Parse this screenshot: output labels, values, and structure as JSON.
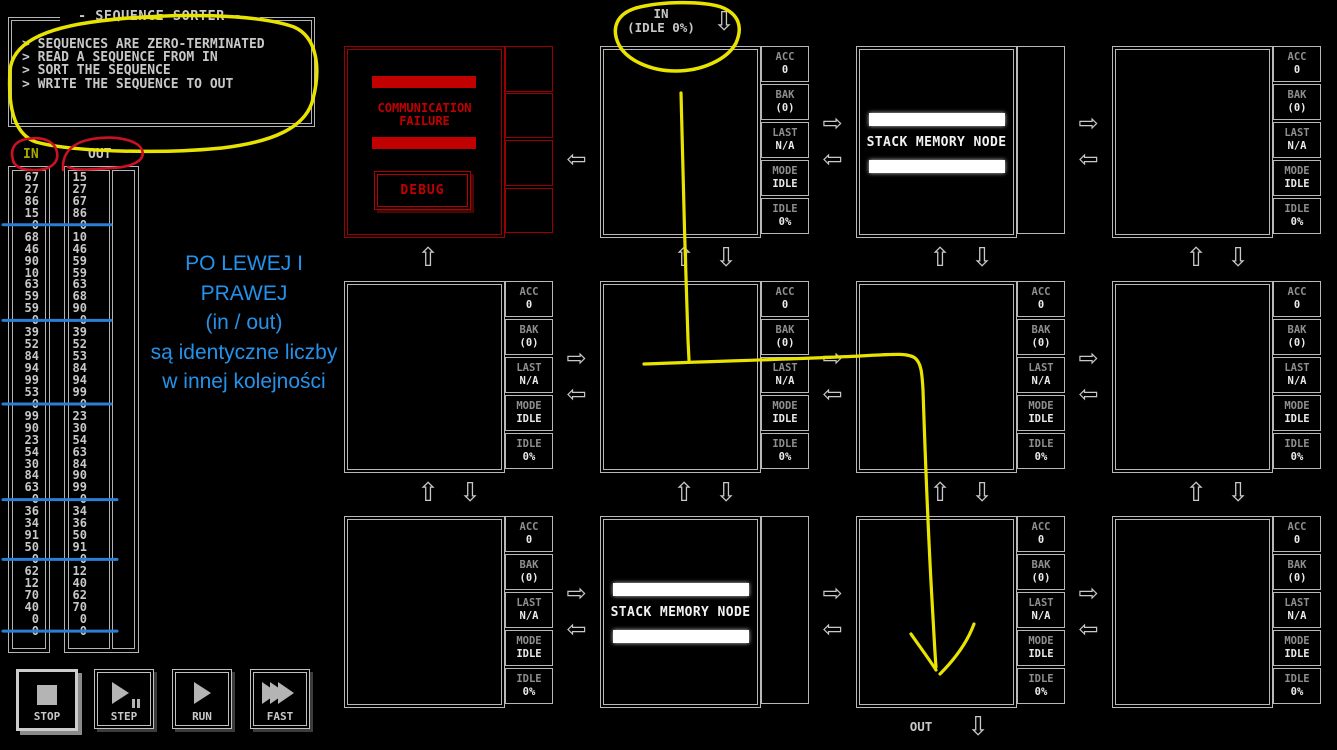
{
  "page": {
    "title": "- SEQUENCE SORTER -"
  },
  "description": [
    "> SEQUENCES ARE ZERO-TERMINATED",
    "> READ A SEQUENCE FROM IN",
    "> SORT THE SEQUENCE",
    "> WRITE THE SEQUENCE TO OUT"
  ],
  "io": {
    "in_label": "IN",
    "out_label": "OUT",
    "in_values": [
      67,
      27,
      86,
      15,
      0,
      68,
      46,
      90,
      10,
      63,
      59,
      59,
      0,
      39,
      52,
      84,
      94,
      99,
      53,
      0,
      99,
      90,
      23,
      54,
      30,
      84,
      63,
      0,
      36,
      34,
      91,
      50,
      0,
      62,
      12,
      70,
      40,
      0,
      0
    ],
    "out_values": [
      15,
      27,
      67,
      86,
      0,
      10,
      46,
      59,
      59,
      63,
      68,
      90,
      0,
      39,
      52,
      53,
      84,
      94,
      99,
      0,
      23,
      30,
      54,
      63,
      84,
      90,
      99,
      0,
      34,
      36,
      50,
      91,
      0,
      12,
      40,
      62,
      70,
      0,
      0
    ]
  },
  "ports": {
    "top_label": "IN",
    "top_status": "(IDLE 0%)",
    "bottom_label": "OUT"
  },
  "controls": [
    {
      "id": "stop",
      "label": "STOP"
    },
    {
      "id": "step",
      "label": "STEP"
    },
    {
      "id": "run",
      "label": "RUN"
    },
    {
      "id": "fast",
      "label": "FAST"
    }
  ],
  "failure_node": {
    "line1": "COMMUNICATION",
    "line2": "FAILURE",
    "button": "DEBUG"
  },
  "stack_node_label": "STACK MEMORY NODE",
  "registers": [
    {
      "label": "ACC",
      "value": "0"
    },
    {
      "label": "BAK",
      "value": "(0)"
    },
    {
      "label": "LAST",
      "value": "N/A"
    },
    {
      "label": "MODE",
      "value": "IDLE"
    },
    {
      "label": "IDLE",
      "value": "0%"
    }
  ],
  "grid": {
    "node_types": [
      [
        "failure",
        "normal",
        "stack",
        "normal"
      ],
      [
        "normal",
        "normal",
        "normal",
        "normal"
      ],
      [
        "normal",
        "stack",
        "normal",
        "normal"
      ]
    ]
  },
  "annotations": {
    "note_lines": [
      "PO LEWEJ I PRAWEJ",
      "(in / out)",
      "są identyczne liczby",
      "w innej kolejności"
    ],
    "colors": {
      "marker_yellow": "#e8e400",
      "marker_red": "#cc1122",
      "marker_blue": "#2b7fd4",
      "note_blue": "#2492ea"
    }
  },
  "ui_colors": {
    "node_border": "#b8b8b8",
    "failure_red": "#c10000",
    "in_header_olive": "#a8aa00"
  }
}
